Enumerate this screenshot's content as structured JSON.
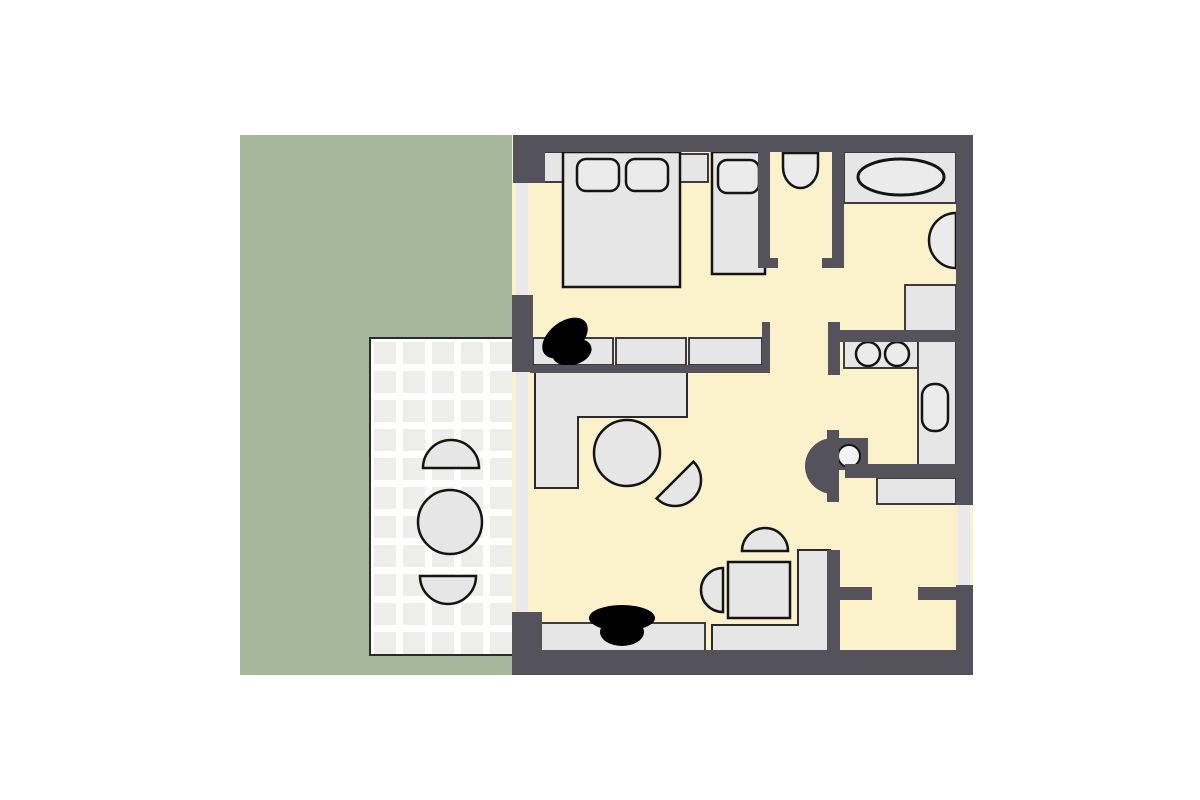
{
  "figure": {
    "type": "floor-plan",
    "description": "apartment floor plan with garden, tiled patio, bedroom, corridor, bathroom, kitchen, living-dining room and entry hall"
  },
  "colors": {
    "page": "#ffffff",
    "garden": "#a5b89b",
    "patio_tile": "#ededea",
    "patio_grout": "#ffffff",
    "patio_border": "#2a2a2a",
    "wall": "#54535b",
    "floor": "#fbf2cb",
    "furniture": "#e6e6e6",
    "furniture_light": "#ebebeb",
    "outline": "#141414",
    "window": "#e9e9eb",
    "black": "#000000"
  },
  "areas": [
    {
      "name": "garden"
    },
    {
      "name": "patio"
    },
    {
      "name": "bedroom"
    },
    {
      "name": "corridor"
    },
    {
      "name": "bathroom"
    },
    {
      "name": "kitchen"
    },
    {
      "name": "living-room"
    },
    {
      "name": "hall"
    },
    {
      "name": "entry-vestibule"
    }
  ],
  "furniture": [
    {
      "name": "double-bed"
    },
    {
      "name": "pillow"
    },
    {
      "name": "nightstand"
    },
    {
      "name": "single-bed"
    },
    {
      "name": "wardrobe"
    },
    {
      "name": "tv-black"
    },
    {
      "name": "corridor-washbasin"
    },
    {
      "name": "bathtub"
    },
    {
      "name": "bathroom-sink"
    },
    {
      "name": "bathroom-cabinet"
    },
    {
      "name": "kitchen-counter"
    },
    {
      "name": "hob-burner"
    },
    {
      "name": "kitchen-sink"
    },
    {
      "name": "stove-column"
    },
    {
      "name": "hall-shelf"
    },
    {
      "name": "corner-sofa"
    },
    {
      "name": "round-table"
    },
    {
      "name": "half-moon-chair"
    },
    {
      "name": "dining-table"
    },
    {
      "name": "dining-chair"
    },
    {
      "name": "corner-bench"
    },
    {
      "name": "sideboard"
    },
    {
      "name": "patio-table"
    },
    {
      "name": "patio-chair"
    }
  ]
}
